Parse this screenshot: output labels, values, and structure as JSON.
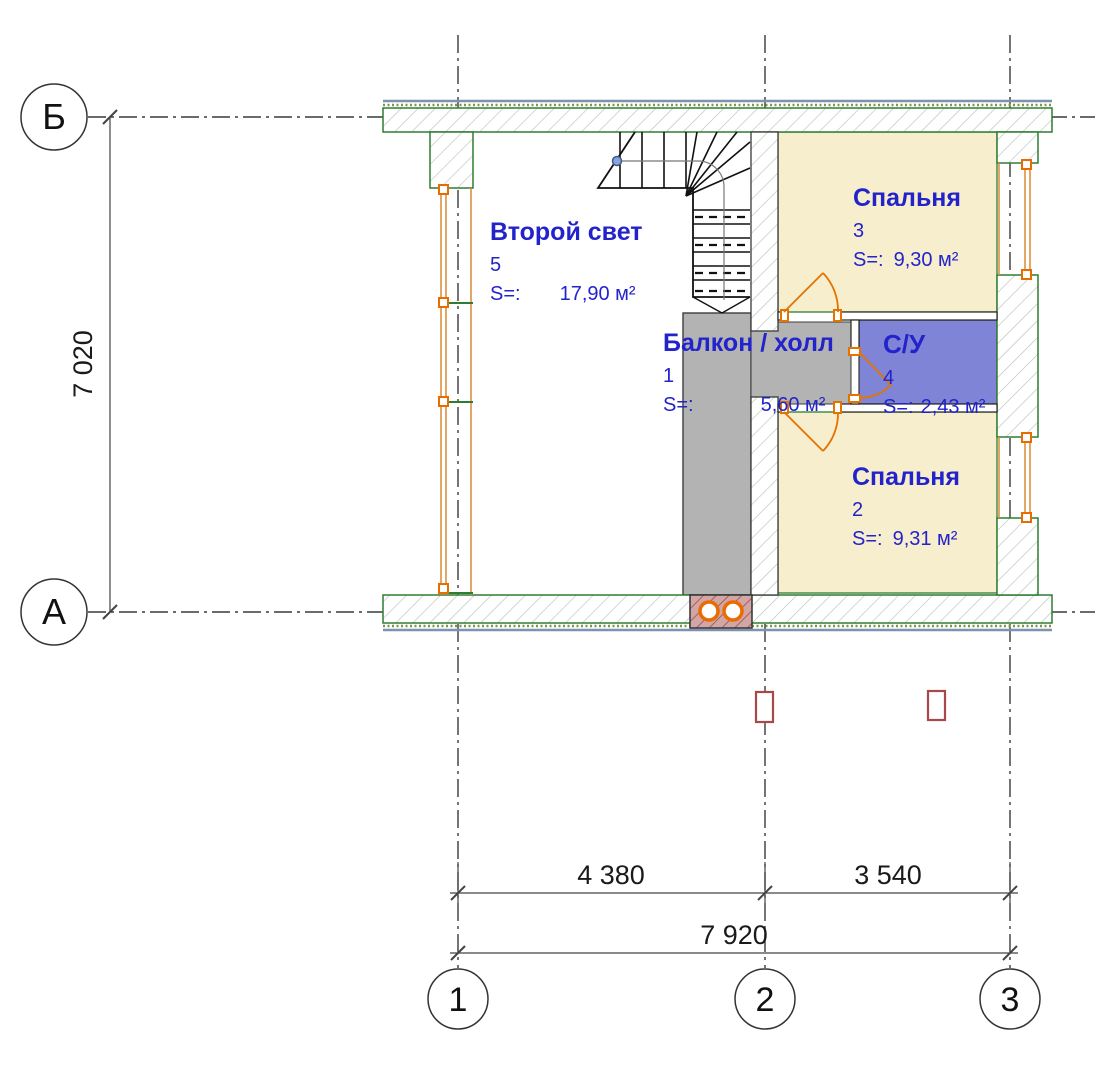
{
  "rooms": [
    {
      "name": "Второй свет",
      "number": "5",
      "s_label": "S=:",
      "area": "17,90 м²"
    },
    {
      "name": "Спальня",
      "number": "3",
      "s_label": "S=:",
      "area": "9,30 м²"
    },
    {
      "name": "Балкон / холл",
      "number": "1",
      "s_label": "S=:",
      "area": "5,60 м²"
    },
    {
      "name": "С/У",
      "number": "4",
      "s_label": "S=:",
      "area": "2,43 м²"
    },
    {
      "name": "Спальня",
      "number": "2",
      "s_label": "S=:",
      "area": "9,31 м²"
    }
  ],
  "grid_axes": {
    "horizontal": [
      "Б",
      "А"
    ],
    "vertical": [
      "1",
      "2",
      "3"
    ]
  },
  "dimensions": {
    "left_height": "7 020",
    "bottom_span_1_2": "4 380",
    "bottom_span_2_3": "3 540",
    "bottom_total": "7 920"
  },
  "colors": {
    "label_blue": "#2323cb",
    "bedroom_fill": "#f7eecd",
    "bathroom_fill": "#7f84d6",
    "hall_fill": "#b3b3b3",
    "wall_outline_green": "#2e7d32",
    "window_orange": "#d98a33",
    "door_orange": "#e57300",
    "chimney_fill": "#d4a5a5"
  }
}
